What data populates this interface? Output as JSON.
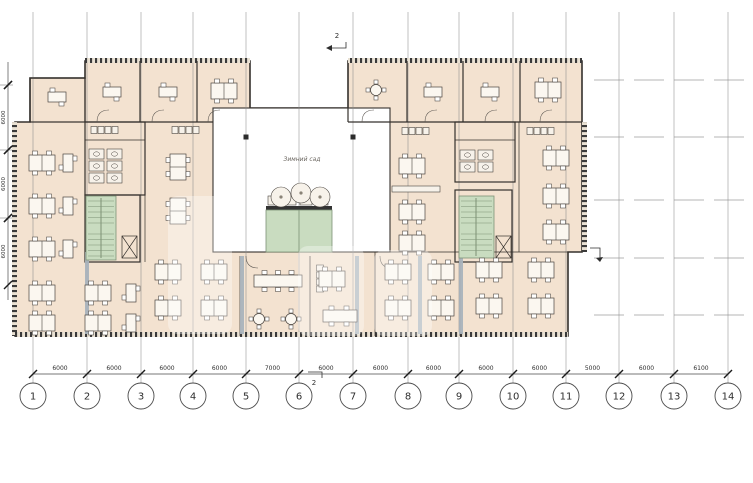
{
  "plan": {
    "courtyard_label": "Зимний сад",
    "section_marker_top": "2",
    "section_marker_bottom": "2"
  },
  "grid": {
    "column_labels": [
      "1",
      "2",
      "3",
      "4",
      "5",
      "6",
      "7",
      "8",
      "9",
      "10",
      "11",
      "12",
      "13",
      "14"
    ],
    "column_xs": [
      33,
      87,
      141,
      193,
      246,
      299,
      353,
      408,
      459,
      513,
      566,
      619,
      674,
      728
    ],
    "span_labels": [
      "6000",
      "6000",
      "6000",
      "6000",
      "7000",
      "6000",
      "6000",
      "6000",
      "6000",
      "6000",
      "5000",
      "6000",
      "6100"
    ],
    "row_ys": [
      80,
      137,
      200,
      258,
      315
    ],
    "left_dim": {
      "tick_ys": [
        85,
        150,
        218,
        285
      ],
      "labels": [
        "6000",
        "6000",
        "6000"
      ]
    }
  },
  "colors": {
    "floor": "#f3e2d0",
    "wall": "#35312d",
    "stair_green": "#c9dcc0",
    "glass_partition": "#a9b3bc",
    "grid_line": "#8d8d8d",
    "courtyard": "#ffffff"
  }
}
